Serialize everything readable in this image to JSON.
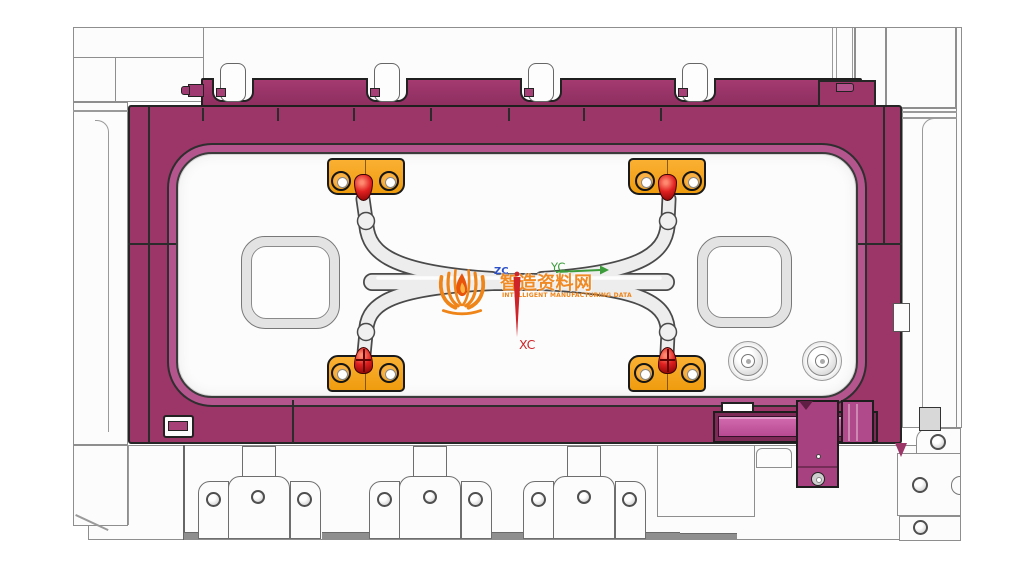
{
  "scene": {
    "description": "CAD top view of an injection mold cavity plate assembly with runner tubes and clamps",
    "background_color": "#ffffff"
  },
  "watermark": {
    "logo": "book-flame-logo",
    "title": "智造资料网",
    "subtitle": "INTELLIGENT MANUFACTURING DATA",
    "color": "#EF8418"
  },
  "axes": {
    "x": {
      "label": "XC",
      "color": "#CE2328",
      "direction": "down"
    },
    "y": {
      "label": "YC",
      "color": "#3C9C3C",
      "direction": "right"
    },
    "z": {
      "label": "ZC",
      "color": "#2B50C8",
      "direction": "out-of-plane"
    }
  },
  "colors": {
    "plate_magenta": "#9C3568",
    "plate_outline": "#262626",
    "cavity_lip": "#B4558E",
    "bracket_orange": "#F7A41C",
    "nozzle_red": "#C41A1A",
    "tube_gray": "#EDEDED",
    "slide_pink": "#C95CA6",
    "white_plate": "#FCFCFC"
  },
  "parts": {
    "mold_plate": "cavity plate (magenta)",
    "clamp_bar_slots": 4,
    "sprue_brackets": 4,
    "red_nozzles": 4,
    "runner_tubes": 5,
    "ball_joints": 4,
    "square_bosses": 2,
    "round_bosses": 2,
    "bottom_clamp_units": 3,
    "latch_assembly": "slide lock (bottom right)"
  }
}
